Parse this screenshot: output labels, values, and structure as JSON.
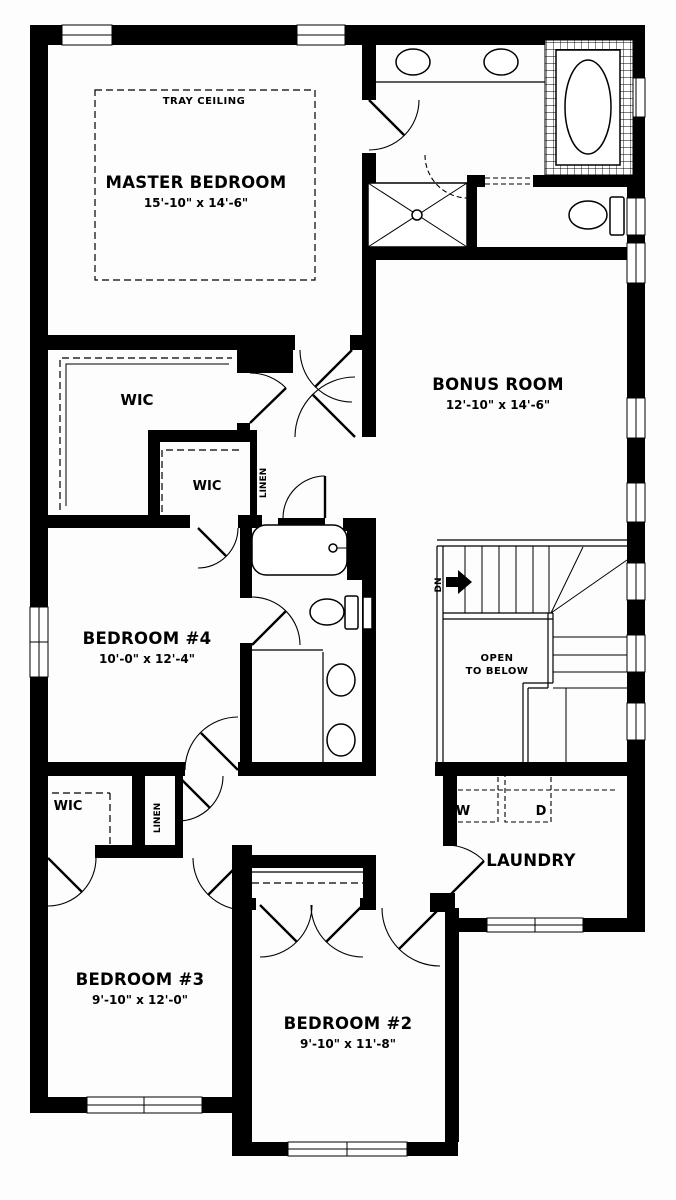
{
  "plan": {
    "tray_ceiling": "TRAY CEILING",
    "master": {
      "name": "MASTER BEDROOM",
      "dims": "15'-10\" x 14'-6\""
    },
    "bonus": {
      "name": "BONUS ROOM",
      "dims": "12'-10\" x 14'-6\""
    },
    "bedroom4": {
      "name": "BEDROOM #4",
      "dims": "10'-0\" x 12'-4\""
    },
    "bedroom3": {
      "name": "BEDROOM #3",
      "dims": "9'-10\" x 12'-0\""
    },
    "bedroom2": {
      "name": "BEDROOM #2",
      "dims": "9'-10\" x 11'-8\""
    },
    "laundry": {
      "name": "LAUNDRY",
      "washer": "W",
      "dryer": "D"
    },
    "wic_master": "WIC",
    "wic_bedroom4": "WIC",
    "wic_bedroom3": "WIC",
    "linen_upper": "LINEN",
    "linen_lower": "LINEN",
    "stairs": {
      "dn": "DN",
      "open_line1": "OPEN",
      "open_line2": "TO BELOW"
    }
  },
  "colors": {
    "wall": "#000000",
    "background": "#ffffff"
  }
}
